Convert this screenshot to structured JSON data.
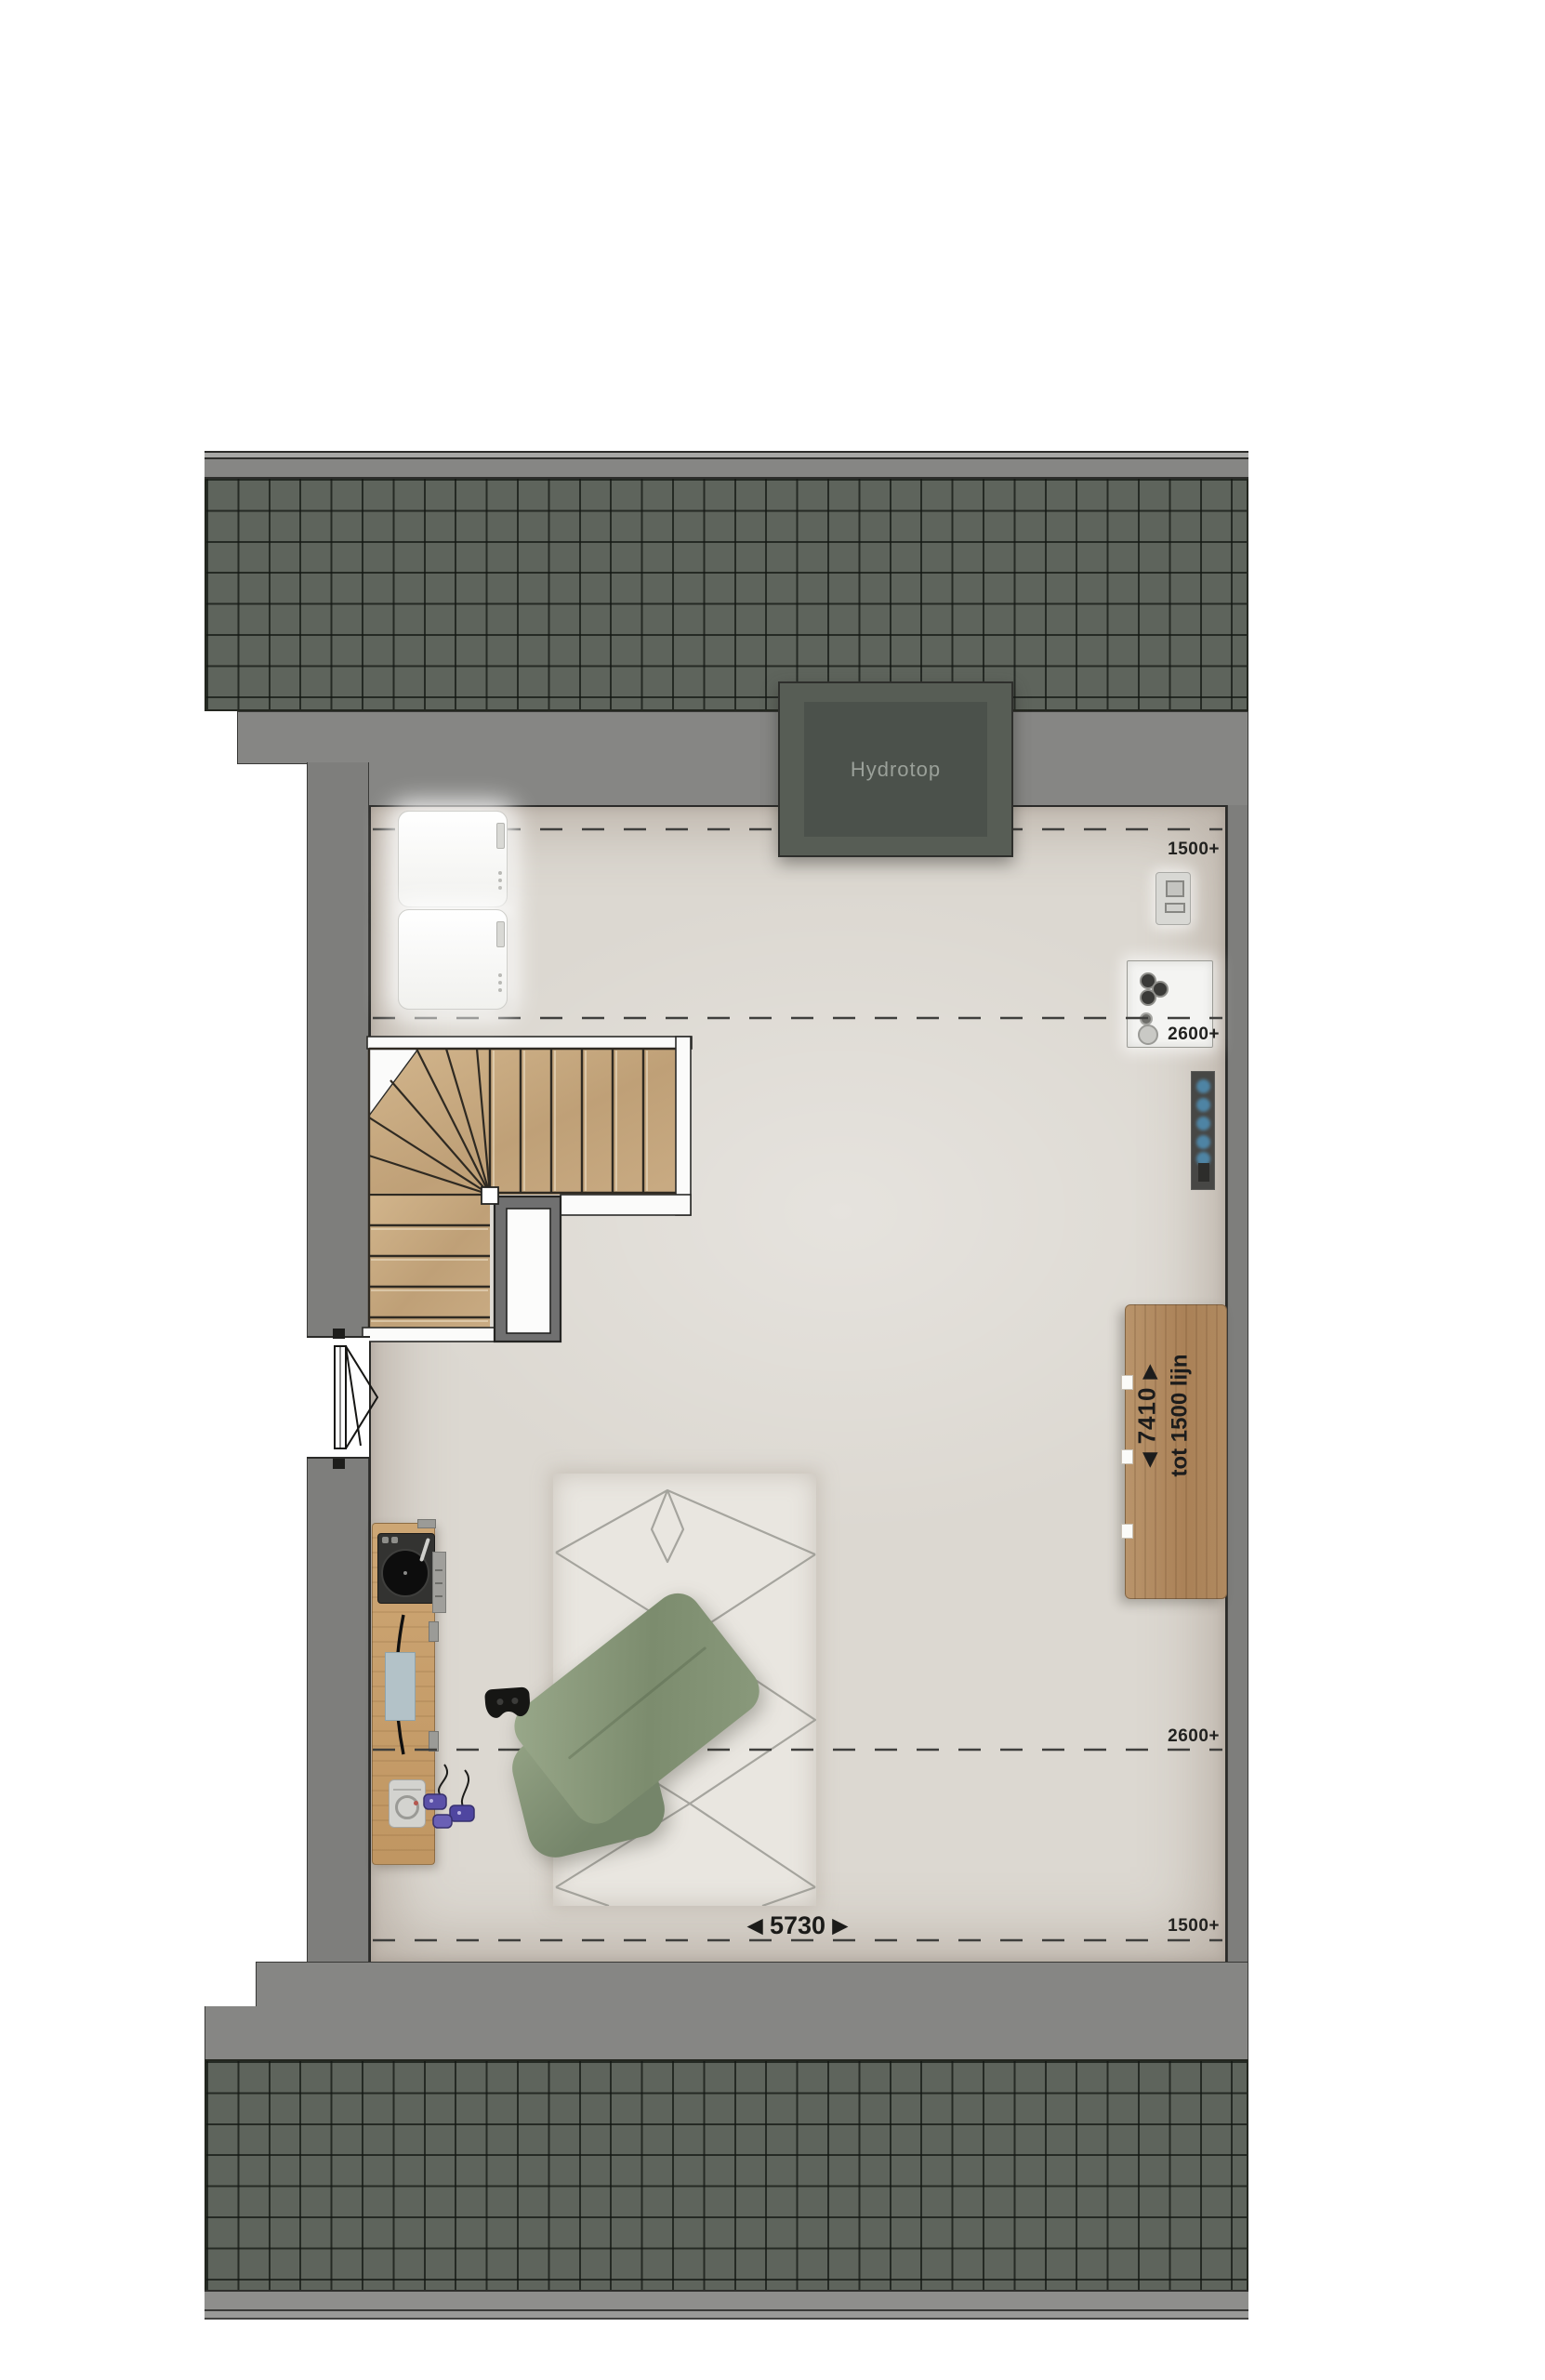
{
  "plan": {
    "unit_label": "Hydrotop",
    "dimensions": {
      "top_right_upper": "1500+",
      "top_right_lower": "2600+",
      "bottom_right_upper": "2600+",
      "bottom_right_lower": "1500+",
      "width": "5730",
      "length": "7410",
      "knee_wall_note": "tot 1500 lijn",
      "arrow_left": "◀",
      "arrow_right": "▶"
    },
    "colors": {
      "roof_tile": "#5e645c",
      "roof_grout": "#2f332e",
      "eaves_gray": "#868684",
      "wall_gray": "#7e7e7c",
      "floor": "#dcd8d1",
      "stair_tread": "#c5a77f",
      "wood": "#b08a5f",
      "pillow_green": "#8b9a7d",
      "radiator_dot_blue": "#4e84a4",
      "hydrotop_box": "#575d55",
      "hydrotop_text": "#9aa099",
      "dash_line": "#3f3f3d",
      "label_text": "#222220"
    }
  }
}
